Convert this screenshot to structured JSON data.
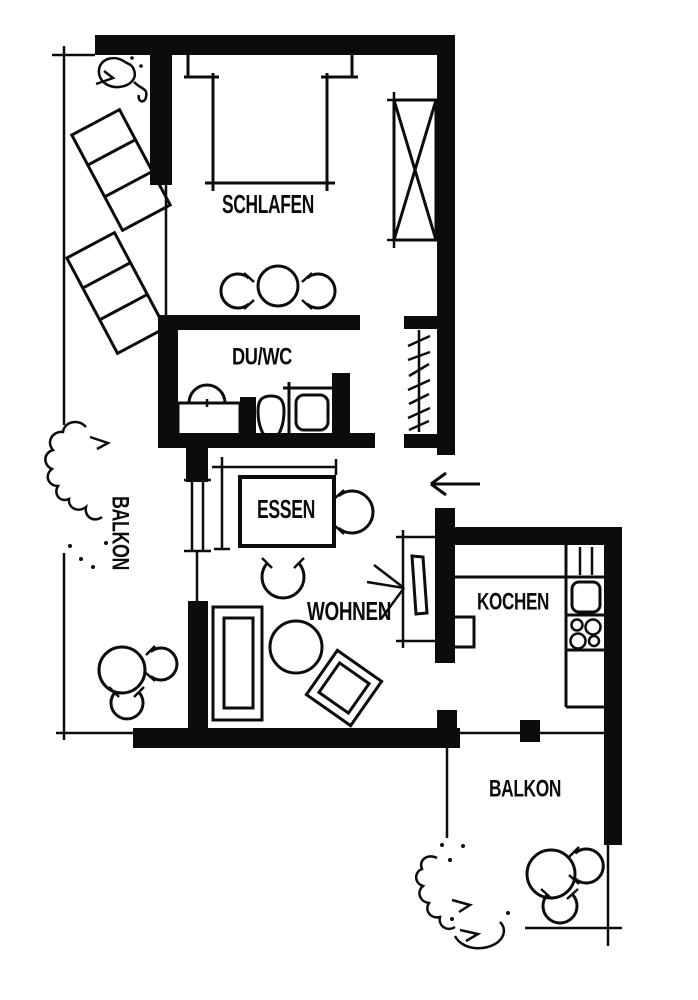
{
  "plan": {
    "kind": "apartment floor plan (scanned, black ink on white)",
    "rooms": {
      "schlafen": {
        "label": "SCHLAFEN"
      },
      "du_wc": {
        "label": "DU/WC"
      },
      "balkon_west": {
        "label": "BALKON"
      },
      "essen": {
        "label": "ESSEN"
      },
      "wohnen": {
        "label": "WOHNEN"
      },
      "kochen": {
        "label": "KOCHEN"
      },
      "balkon_sued": {
        "label": "BALKON"
      }
    },
    "colors": {
      "ink": "#0c0c0c",
      "paper": "#ffffff"
    }
  }
}
